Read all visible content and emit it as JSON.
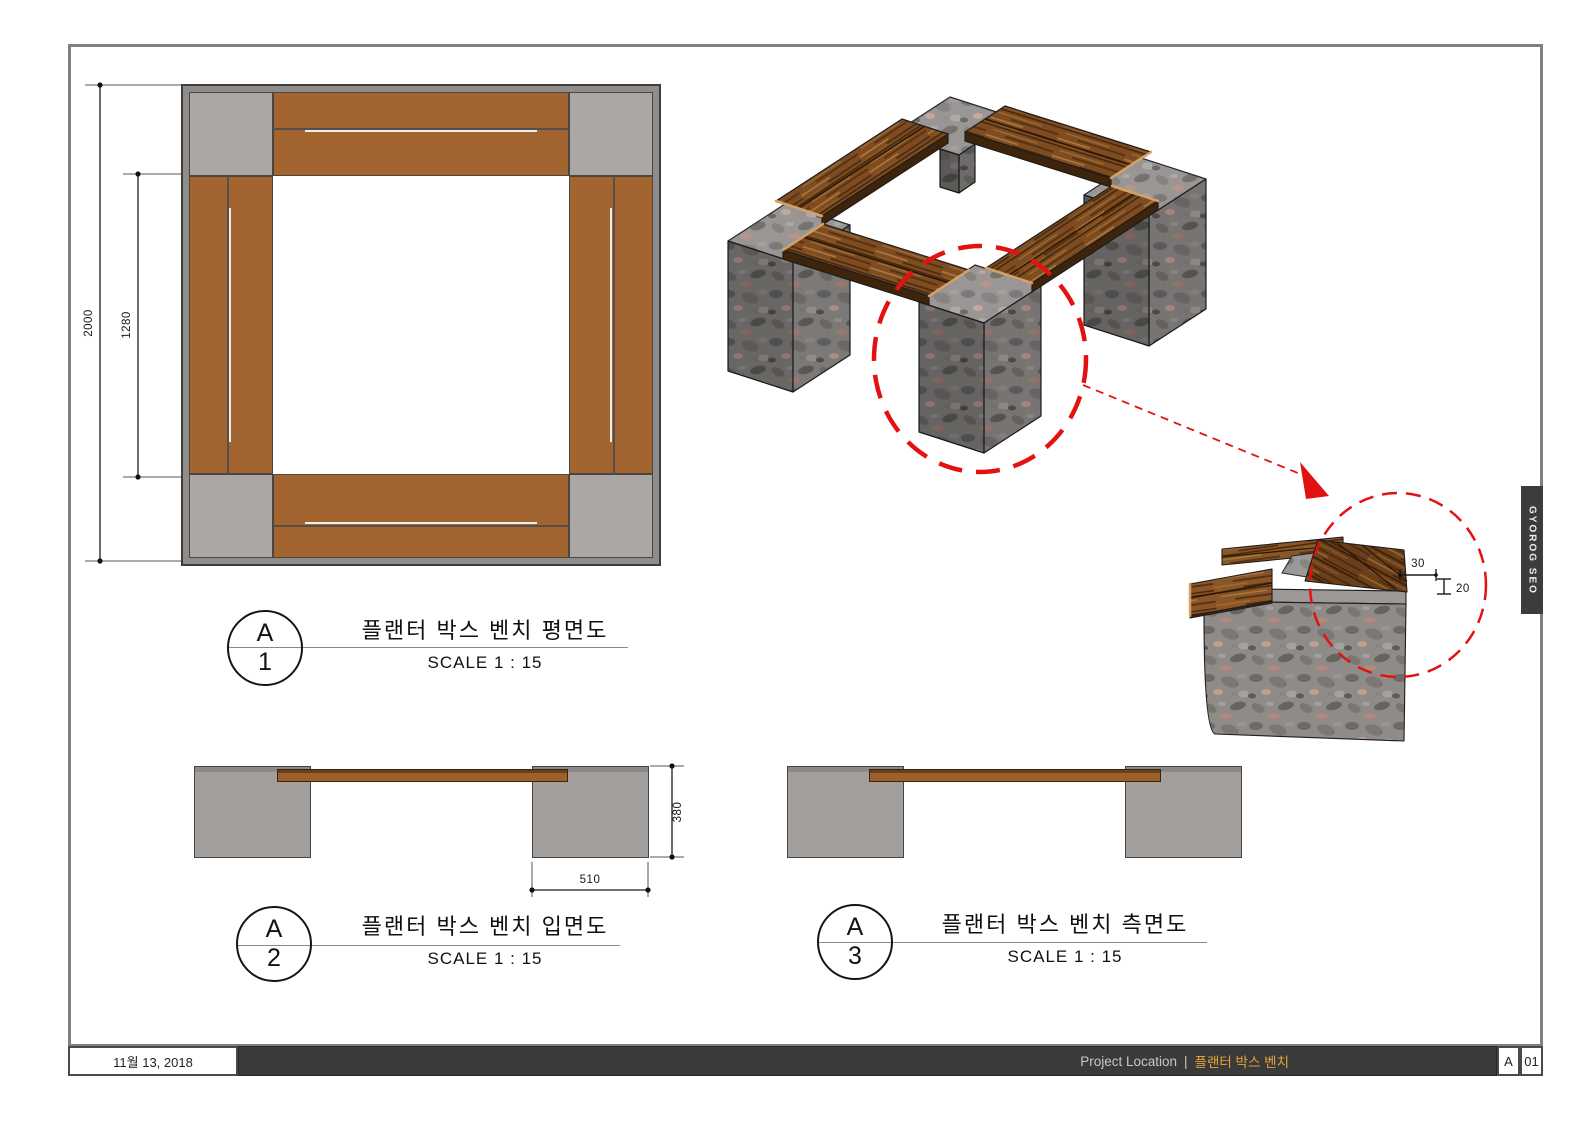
{
  "sheet": {
    "type": "construction-drawing"
  },
  "views": {
    "plan": {
      "marker_letter": "A",
      "marker_number": "1",
      "title": "플랜터 박스 벤치 평면도",
      "scale": "SCALE 1 : 15",
      "dim_outer": "2000",
      "dim_inner": "1280"
    },
    "elevation": {
      "marker_letter": "A",
      "marker_number": "2",
      "title": "플랜터 박스 벤치 입면도",
      "scale": "SCALE 1 : 15",
      "dim_height": "380",
      "dim_block": "510"
    },
    "side": {
      "marker_letter": "A",
      "marker_number": "3",
      "title": "플랜터 박스 벤치 측면도",
      "scale": "SCALE 1 : 15"
    },
    "detail": {
      "dim_overhang": "30",
      "dim_thickness": "20"
    }
  },
  "footer": {
    "date": "11월 13, 2018",
    "project_label": "Project Location",
    "separator": "|",
    "project_name": "플랜터 박스 벤치",
    "revision": "A",
    "sheet_number": "01"
  },
  "side_tab": {
    "text": "GYOROG SEO"
  },
  "colors": {
    "wood_plan": "#a2652f",
    "wood_3d": "#7e4c20",
    "stone_gray": "#aaa7a4",
    "granite_base": "#8e8b89",
    "elevation_block": "#a29f9c",
    "elevation_plank": "#9d602c",
    "annotation_red": "#e31212",
    "footer_bar": "#3a3a3a",
    "accent_orange": "#e7a23b",
    "sheet_border": "#7f7f7f"
  }
}
